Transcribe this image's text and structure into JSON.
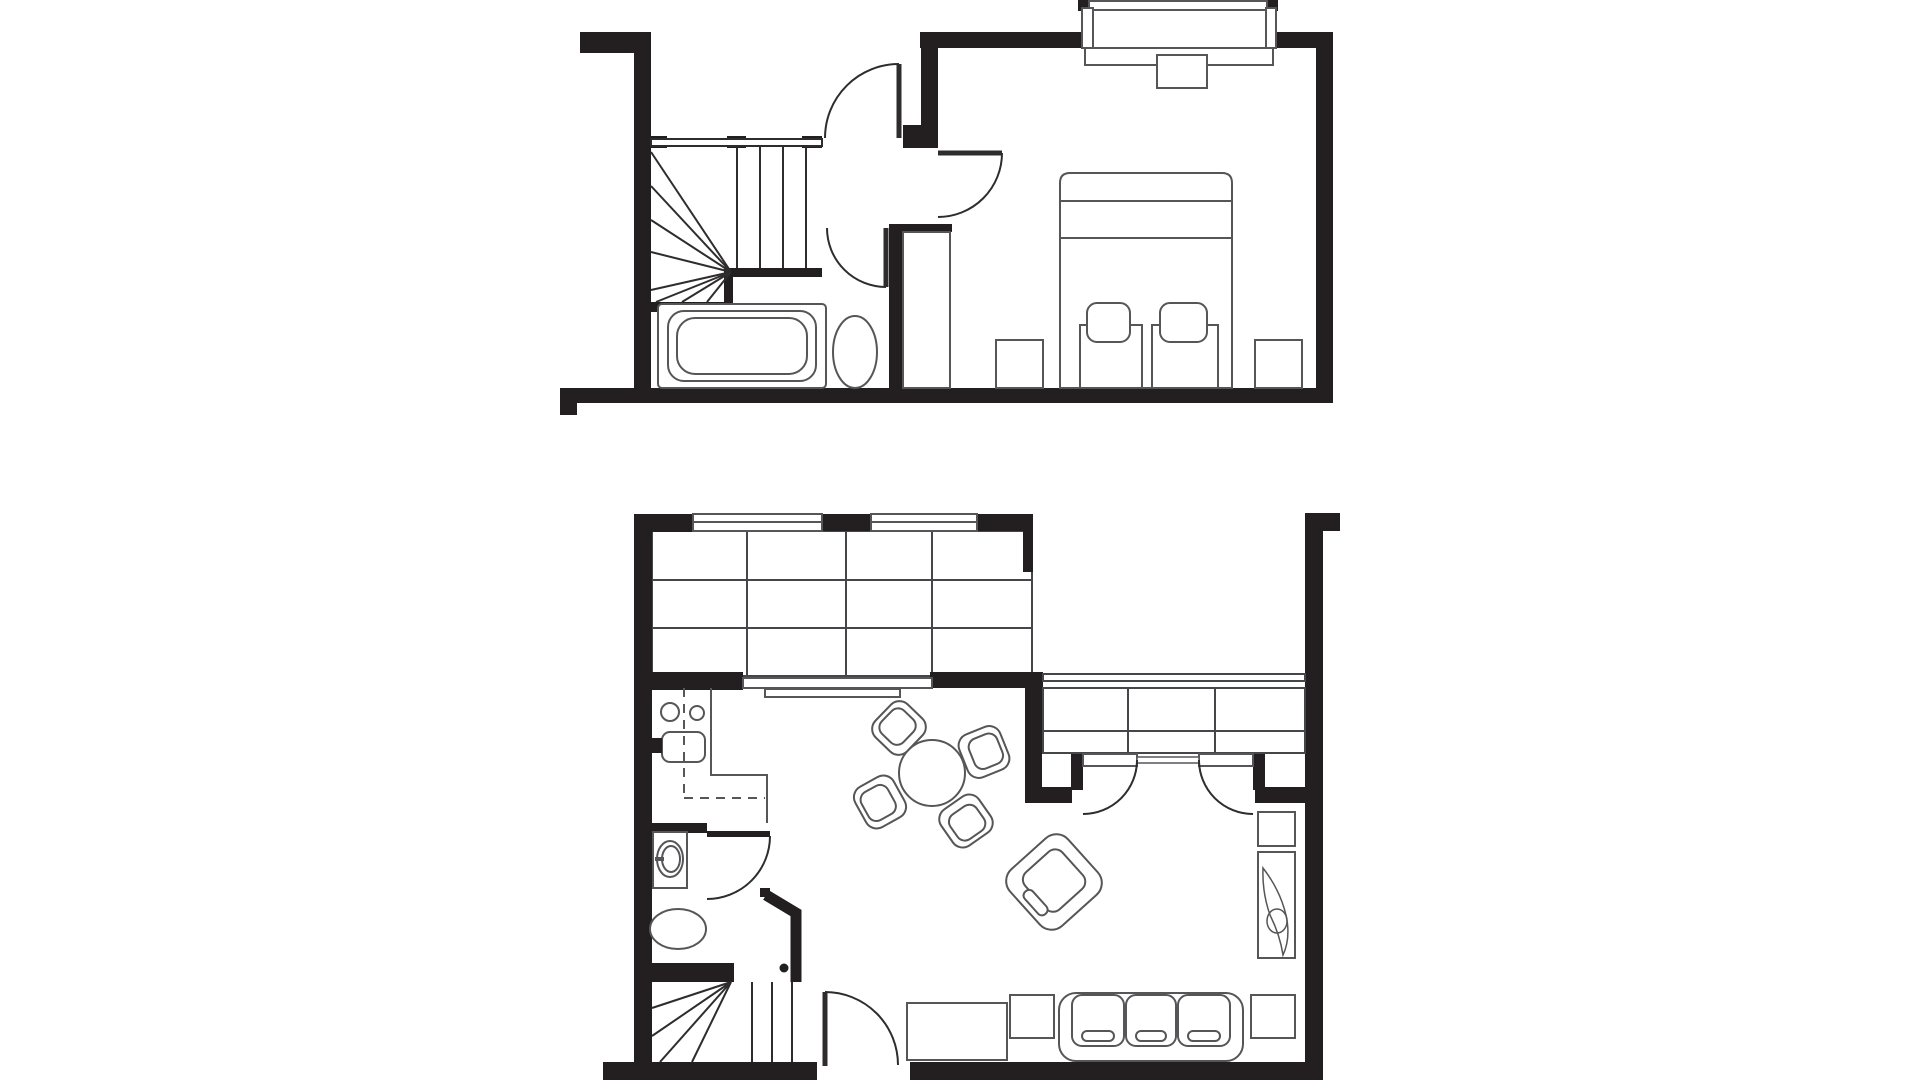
{
  "document": {
    "kind": "architectural-floor-plan",
    "background": "#ffffff",
    "plan_count": 2
  },
  "colors": {
    "wall": "#231f20",
    "line": "#2e2c2d",
    "furniture": "#565658",
    "background": "#ffffff"
  },
  "plans": [
    {
      "id": "upper-floor",
      "position": "top",
      "rooms": [
        "stair-landing",
        "bathroom",
        "bedroom"
      ],
      "features": [
        "winder-staircase",
        "landing-rail",
        "landing-door",
        "bedroom-door",
        "bathroom-door",
        "built-in-closet",
        "bathtub",
        "toilet",
        "double-bed",
        "pillows",
        "nightstand-left",
        "nightstand-right",
        "bay-window",
        "radiator"
      ]
    },
    {
      "id": "ground-floor",
      "position": "bottom",
      "rooms": [
        "kitchen",
        "utility-nook",
        "wc",
        "dining-area",
        "living-room"
      ],
      "features": [
        "kitchen-cabinet-grid",
        "kitchen-windows",
        "counter-front",
        "utility-sink",
        "dashed-appliance-outline",
        "wc-door",
        "wc-vanity",
        "wc-toilet",
        "winder-staircase",
        "entry-door",
        "dining-table",
        "dining-chairs",
        "armchair",
        "french-doors",
        "window-seat-unit",
        "sofa",
        "sofa-side-cushions",
        "tv-stand",
        "side-table",
        "lounger-with-plant"
      ]
    }
  ]
}
